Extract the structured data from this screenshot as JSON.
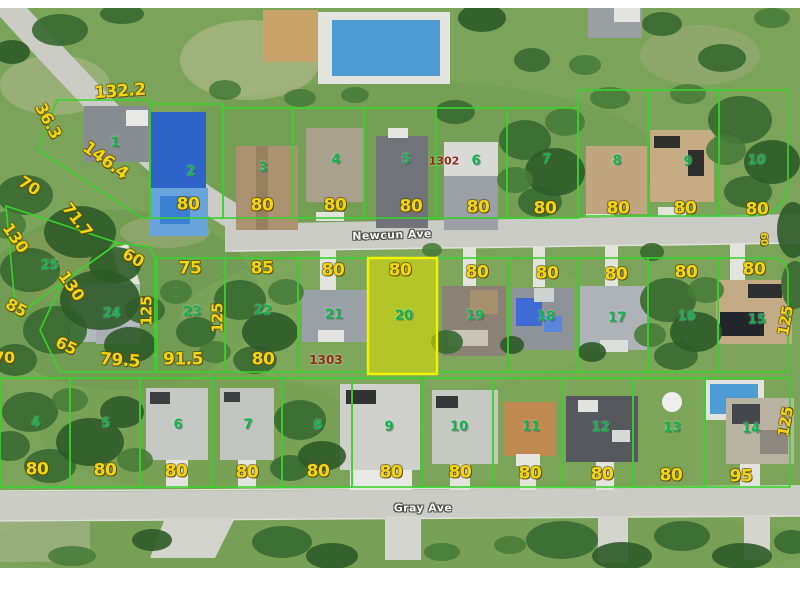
{
  "highlighted_lot": "20",
  "streets": [
    {
      "text": "Newcun Ave",
      "x": 392,
      "y": 235,
      "rot": -2,
      "size": 11
    },
    {
      "text": "Gray Ave",
      "x": 423,
      "y": 508,
      "rot": 0,
      "size": 11
    }
  ],
  "plat_numbers": [
    {
      "text": "1302",
      "x": 444,
      "y": 161,
      "rot": 0,
      "size": 11
    },
    {
      "text": "1303",
      "x": 326,
      "y": 360,
      "rot": 0,
      "size": 12
    }
  ],
  "lot_numbers": [
    {
      "text": "1",
      "x": 115,
      "y": 143
    },
    {
      "text": "2",
      "x": 191,
      "y": 172
    },
    {
      "text": "3",
      "x": 263,
      "y": 168
    },
    {
      "text": "4",
      "x": 336,
      "y": 160
    },
    {
      "text": "5",
      "x": 406,
      "y": 160
    },
    {
      "text": "6",
      "x": 476,
      "y": 161
    },
    {
      "text": "7",
      "x": 547,
      "y": 160
    },
    {
      "text": "8",
      "x": 617,
      "y": 161
    },
    {
      "text": "9",
      "x": 688,
      "y": 162
    },
    {
      "text": "10",
      "x": 757,
      "y": 161
    },
    {
      "text": "25",
      "x": 50,
      "y": 266
    },
    {
      "text": "24",
      "x": 112,
      "y": 314
    },
    {
      "text": "23",
      "x": 192,
      "y": 312
    },
    {
      "text": "22",
      "x": 263,
      "y": 311
    },
    {
      "text": "21",
      "x": 334,
      "y": 315
    },
    {
      "text": "20",
      "x": 404,
      "y": 316
    },
    {
      "text": "19",
      "x": 475,
      "y": 316
    },
    {
      "text": "18",
      "x": 546,
      "y": 317
    },
    {
      "text": "17",
      "x": 617,
      "y": 318
    },
    {
      "text": "16",
      "x": 687,
      "y": 317
    },
    {
      "text": "15",
      "x": 757,
      "y": 320
    },
    {
      "text": "4",
      "x": 36,
      "y": 423
    },
    {
      "text": "5",
      "x": 106,
      "y": 424
    },
    {
      "text": "6",
      "x": 178,
      "y": 425
    },
    {
      "text": "7",
      "x": 248,
      "y": 425
    },
    {
      "text": "8",
      "x": 318,
      "y": 426
    },
    {
      "text": "9",
      "x": 389,
      "y": 427
    },
    {
      "text": "10",
      "x": 459,
      "y": 427
    },
    {
      "text": "11",
      "x": 531,
      "y": 427
    },
    {
      "text": "12",
      "x": 601,
      "y": 428
    },
    {
      "text": "13",
      "x": 672,
      "y": 428
    },
    {
      "text": "14",
      "x": 751,
      "y": 429
    }
  ],
  "dimension_labels": [
    {
      "text": "132.2",
      "x": 120,
      "y": 92,
      "rot": -4,
      "size": 17
    },
    {
      "text": "36.3",
      "x": 48,
      "y": 121,
      "rot": 62,
      "size": 16
    },
    {
      "text": "146.4",
      "x": 105,
      "y": 161,
      "rot": 36,
      "size": 17
    },
    {
      "text": "70",
      "x": 29,
      "y": 186,
      "rot": 32,
      "size": 16
    },
    {
      "text": "71.7",
      "x": 77,
      "y": 220,
      "rot": 52,
      "size": 16
    },
    {
      "text": "130",
      "x": 15,
      "y": 238,
      "rot": 55,
      "size": 16
    },
    {
      "text": "130",
      "x": 71,
      "y": 286,
      "rot": 55,
      "size": 16
    },
    {
      "text": "85",
      "x": 16,
      "y": 308,
      "rot": 28,
      "size": 16
    },
    {
      "text": "65",
      "x": 66,
      "y": 346,
      "rot": 26,
      "size": 16
    },
    {
      "text": "70",
      "x": 4,
      "y": 358,
      "rot": 0,
      "size": 16
    },
    {
      "text": "60",
      "x": 133,
      "y": 258,
      "rot": 30,
      "size": 16
    },
    {
      "text": "79.5",
      "x": 120,
      "y": 361,
      "rot": 4,
      "size": 17
    },
    {
      "text": "91.5",
      "x": 183,
      "y": 360,
      "rot": 0,
      "size": 17
    },
    {
      "text": "80",
      "x": 188,
      "y": 205,
      "rot": 0,
      "size": 17
    },
    {
      "text": "80",
      "x": 262,
      "y": 206,
      "rot": 0,
      "size": 17
    },
    {
      "text": "80",
      "x": 335,
      "y": 206,
      "rot": 0,
      "size": 17
    },
    {
      "text": "80",
      "x": 411,
      "y": 207,
      "rot": 0,
      "size": 17
    },
    {
      "text": "80",
      "x": 478,
      "y": 208,
      "rot": 0,
      "size": 17
    },
    {
      "text": "80",
      "x": 545,
      "y": 209,
      "rot": 0,
      "size": 17
    },
    {
      "text": "80",
      "x": 618,
      "y": 209,
      "rot": 0,
      "size": 17
    },
    {
      "text": "80",
      "x": 685,
      "y": 209,
      "rot": 0,
      "size": 17
    },
    {
      "text": "80",
      "x": 757,
      "y": 210,
      "rot": 0,
      "size": 17
    },
    {
      "text": "60",
      "x": 763,
      "y": 239,
      "rot": 90,
      "size": 10
    },
    {
      "text": "75",
      "x": 190,
      "y": 269,
      "rot": 0,
      "size": 17
    },
    {
      "text": "85",
      "x": 262,
      "y": 269,
      "rot": 0,
      "size": 17
    },
    {
      "text": "80",
      "x": 333,
      "y": 271,
      "rot": 0,
      "size": 17
    },
    {
      "text": "80",
      "x": 400,
      "y": 271,
      "rot": 0,
      "size": 17
    },
    {
      "text": "80",
      "x": 477,
      "y": 273,
      "rot": 0,
      "size": 17
    },
    {
      "text": "80",
      "x": 547,
      "y": 274,
      "rot": 0,
      "size": 17
    },
    {
      "text": "80",
      "x": 616,
      "y": 275,
      "rot": 0,
      "size": 17
    },
    {
      "text": "80",
      "x": 686,
      "y": 273,
      "rot": 0,
      "size": 17
    },
    {
      "text": "80",
      "x": 754,
      "y": 270,
      "rot": 0,
      "size": 17
    },
    {
      "text": "125",
      "x": 147,
      "y": 311,
      "rot": -90,
      "size": 15
    },
    {
      "text": "125",
      "x": 218,
      "y": 318,
      "rot": -90,
      "size": 15
    },
    {
      "text": "125",
      "x": 786,
      "y": 321,
      "rot": -80,
      "size": 15
    },
    {
      "text": "125",
      "x": 786,
      "y": 422,
      "rot": -80,
      "size": 15
    },
    {
      "text": "80",
      "x": 263,
      "y": 360,
      "rot": 0,
      "size": 17
    },
    {
      "text": "80",
      "x": 37,
      "y": 470,
      "rot": 0,
      "size": 17
    },
    {
      "text": "80",
      "x": 105,
      "y": 471,
      "rot": 0,
      "size": 17
    },
    {
      "text": "80",
      "x": 176,
      "y": 472,
      "rot": 0,
      "size": 17
    },
    {
      "text": "80",
      "x": 247,
      "y": 473,
      "rot": 0,
      "size": 17
    },
    {
      "text": "80",
      "x": 318,
      "y": 472,
      "rot": 0,
      "size": 17
    },
    {
      "text": "80",
      "x": 391,
      "y": 473,
      "rot": 0,
      "size": 17
    },
    {
      "text": "80",
      "x": 460,
      "y": 473,
      "rot": 0,
      "size": 17
    },
    {
      "text": "80",
      "x": 530,
      "y": 474,
      "rot": 0,
      "size": 17
    },
    {
      "text": "80",
      "x": 602,
      "y": 475,
      "rot": 0,
      "size": 17
    },
    {
      "text": "80",
      "x": 671,
      "y": 476,
      "rot": 0,
      "size": 17
    },
    {
      "text": "95",
      "x": 741,
      "y": 477,
      "rot": 0,
      "size": 17
    }
  ],
  "colors": {
    "parcel_line": "#38d32c",
    "dimension_text": "#f4d60b",
    "lot_number_text": "#12b24c",
    "plat_number_text": "#8f2d18",
    "street_text": "#f6f6f4",
    "highlight_fill": "#dcde00",
    "highlight_stroke": "#f2f200",
    "road": "#cbccc6",
    "grass": "#7ba45a"
  }
}
